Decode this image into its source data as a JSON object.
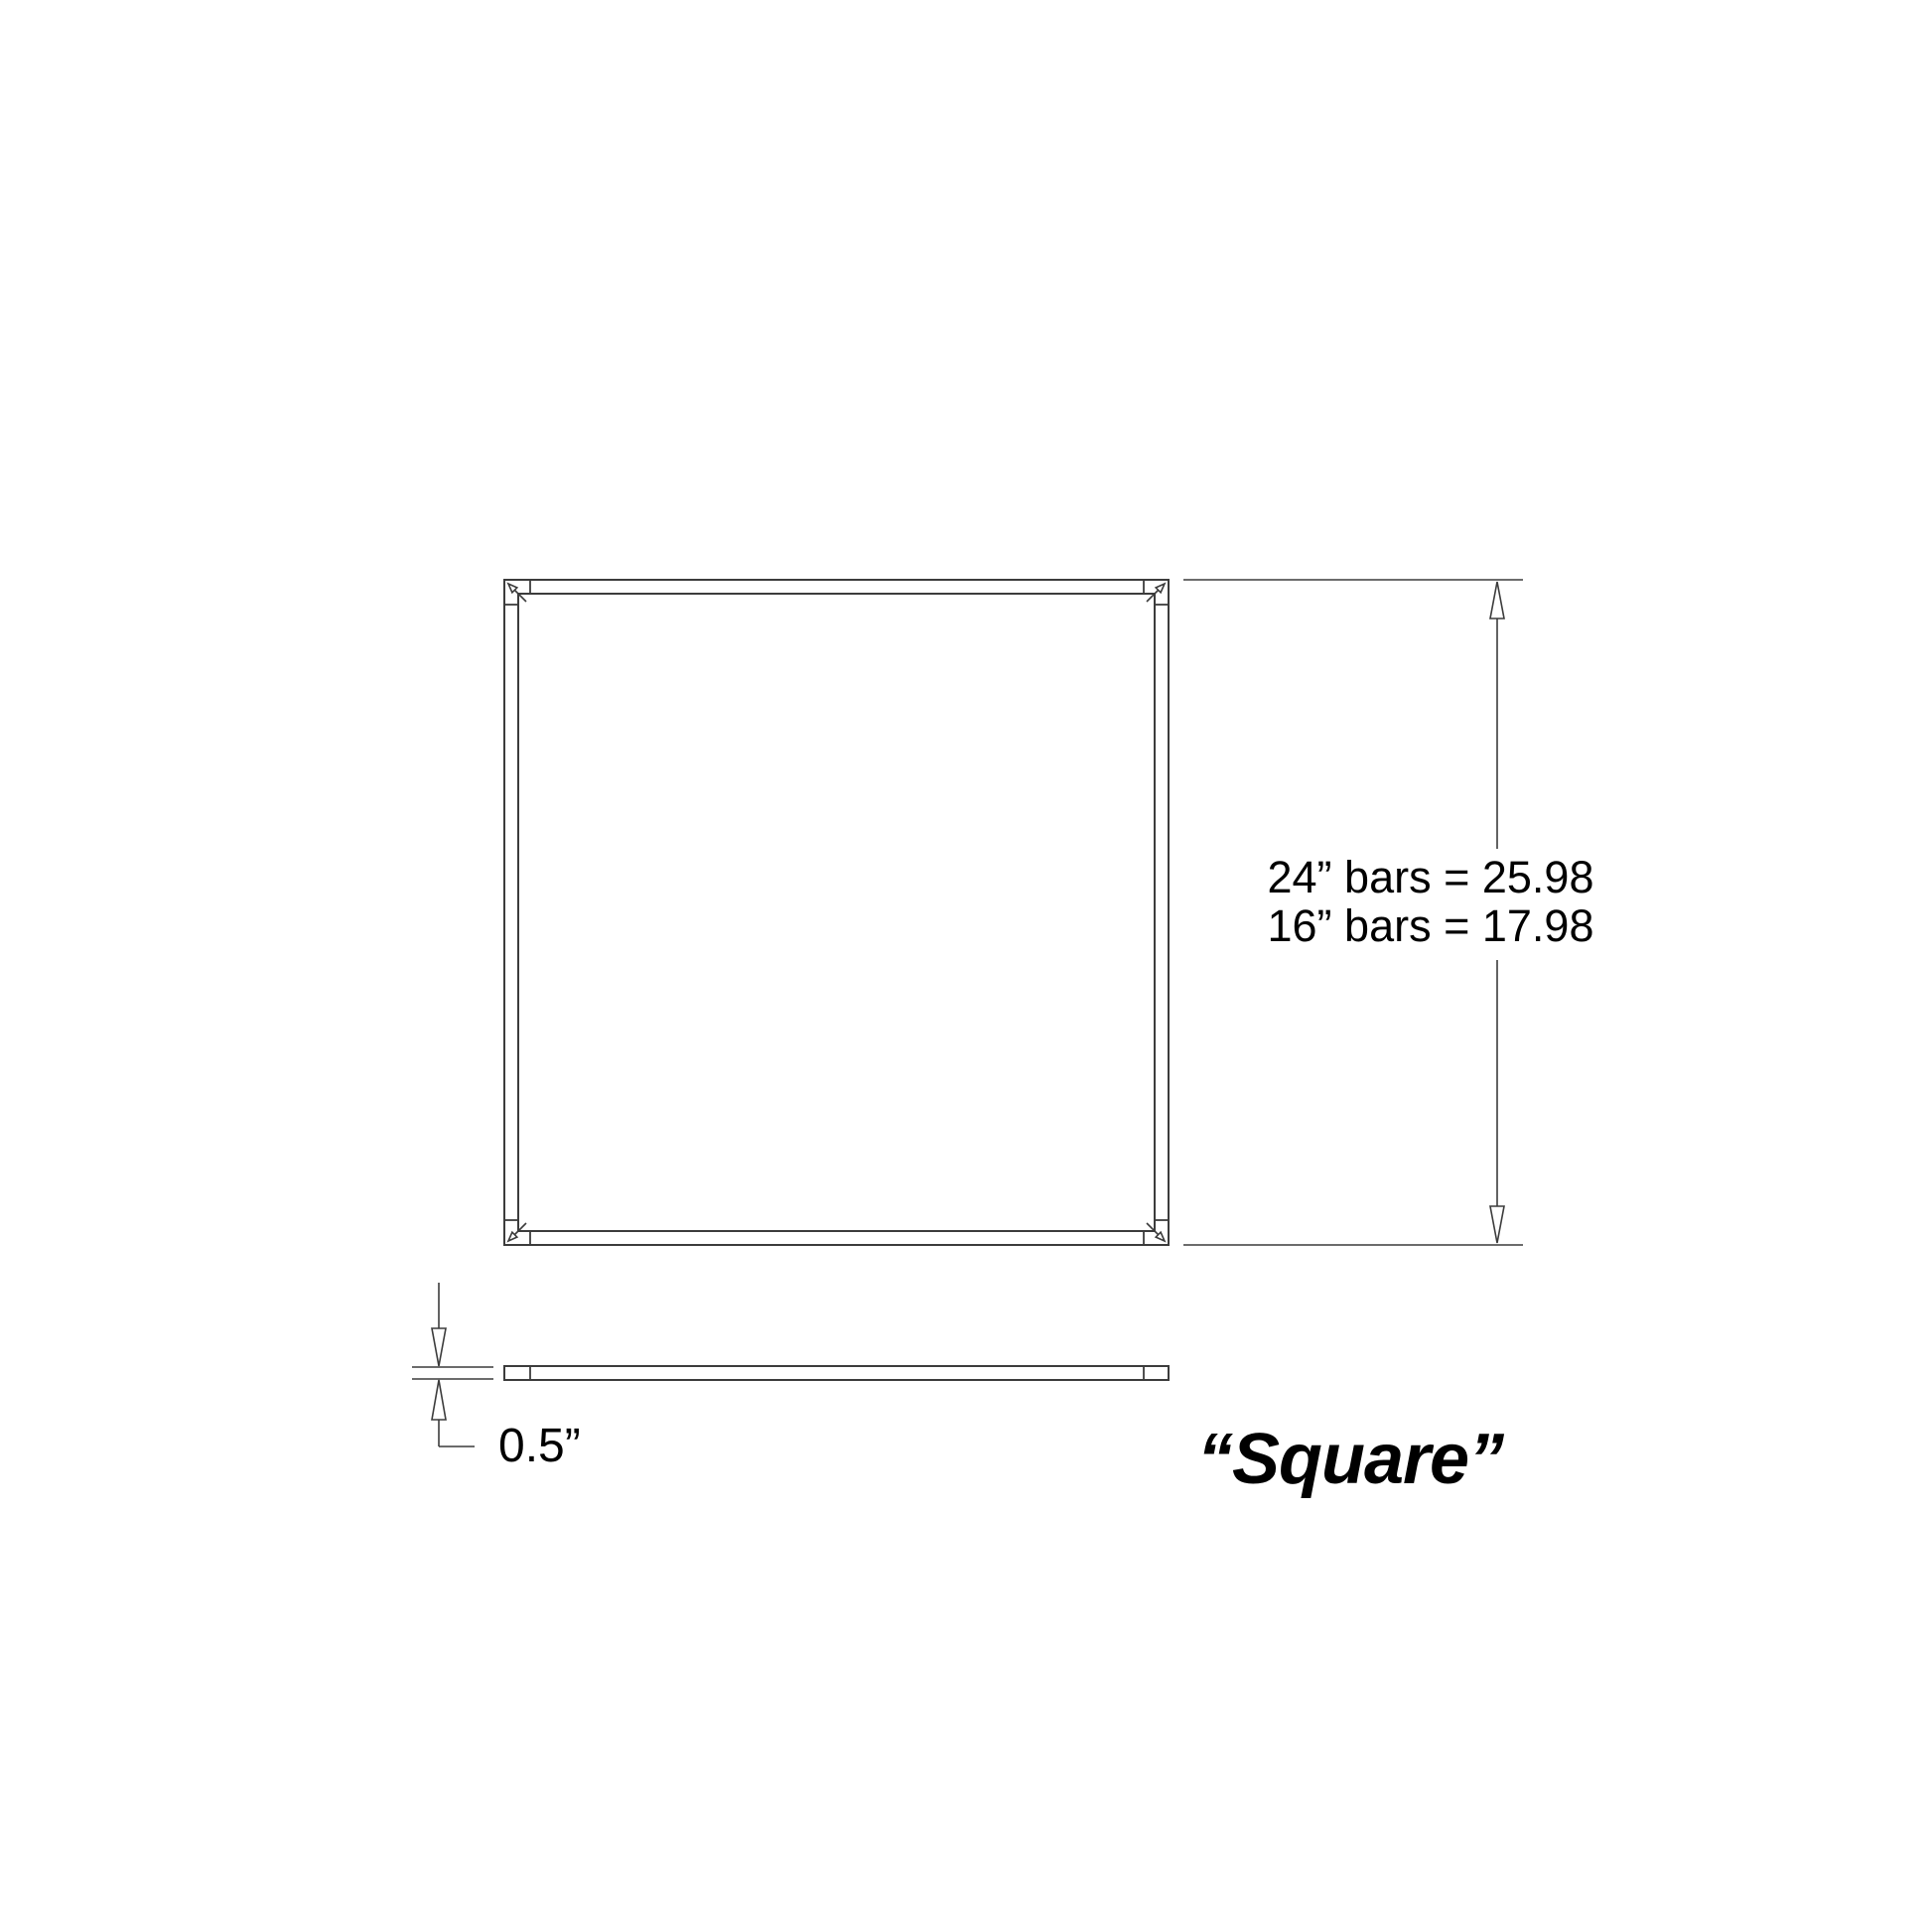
{
  "colors": {
    "background": "#ffffff",
    "line": "#3c3c3c",
    "text": "#000000"
  },
  "height_dimension": {
    "line1": "24” bars = 25.98",
    "line2": "16” bars = 17.98"
  },
  "thickness_dimension": {
    "label": "0.5”"
  },
  "title": {
    "text": "“Square”"
  }
}
